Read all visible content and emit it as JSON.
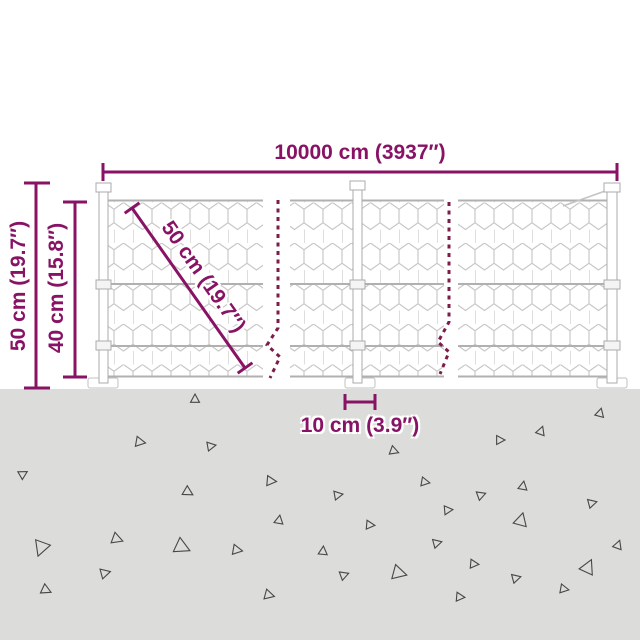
{
  "diagram": {
    "kind": "product-dimension-diagram",
    "subject": "chicken-wire mesh fence with ground spikes",
    "dimensions": {
      "total_length": "10000 cm (3937″)",
      "post_height": "50 cm (19.7″)",
      "mesh_height": "40 cm (15.8″)",
      "mesh_diagonal": "50 cm (19.7″)",
      "base_width": "10 cm (3.9″)"
    },
    "colors": {
      "dimension": "#881365",
      "break_line": "#7c1c4b",
      "mesh": "#c8c8c8",
      "wire": "#b0b0b0",
      "post_outline": "#ababab",
      "ground": "#dcdcda",
      "triangle_outline": "#474747",
      "background": "#ffffff"
    },
    "ground": {
      "triangles": [
        {
          "x": 195,
          "y": 399,
          "s": 8,
          "r": 0
        },
        {
          "x": 140,
          "y": 442,
          "s": 9,
          "r": 100
        },
        {
          "x": 211,
          "y": 446,
          "s": 8,
          "r": 80
        },
        {
          "x": 23,
          "y": 474,
          "s": 8,
          "r": 60
        },
        {
          "x": 271,
          "y": 481,
          "s": 9,
          "r": 95
        },
        {
          "x": 188,
          "y": 492,
          "s": 9,
          "r": 120
        },
        {
          "x": 279,
          "y": 520,
          "s": 8,
          "r": 10
        },
        {
          "x": 117,
          "y": 539,
          "s": 10,
          "r": 110
        },
        {
          "x": 41,
          "y": 548,
          "s": 14,
          "r": 200
        },
        {
          "x": 182,
          "y": 547,
          "s": 14,
          "r": 115
        },
        {
          "x": 237,
          "y": 550,
          "s": 9,
          "r": 100
        },
        {
          "x": 105,
          "y": 573,
          "s": 9,
          "r": 75
        },
        {
          "x": 46,
          "y": 590,
          "s": 9,
          "r": 115
        },
        {
          "x": 269,
          "y": 595,
          "s": 9,
          "r": 105
        },
        {
          "x": 600,
          "y": 413,
          "s": 8,
          "r": 15
        },
        {
          "x": 541,
          "y": 431,
          "s": 8,
          "r": 20
        },
        {
          "x": 500,
          "y": 440,
          "s": 8,
          "r": 90
        },
        {
          "x": 394,
          "y": 451,
          "s": 8,
          "r": 110
        },
        {
          "x": 425,
          "y": 482,
          "s": 8,
          "r": 100
        },
        {
          "x": 338,
          "y": 495,
          "s": 8,
          "r": 80
        },
        {
          "x": 523,
          "y": 486,
          "s": 8,
          "r": 10
        },
        {
          "x": 481,
          "y": 495,
          "s": 8,
          "r": 70
        },
        {
          "x": 592,
          "y": 503,
          "s": 8,
          "r": 75
        },
        {
          "x": 448,
          "y": 510,
          "s": 8,
          "r": 85
        },
        {
          "x": 370,
          "y": 525,
          "s": 8,
          "r": 95
        },
        {
          "x": 521,
          "y": 520,
          "s": 12,
          "r": 15
        },
        {
          "x": 437,
          "y": 543,
          "s": 8,
          "r": 75
        },
        {
          "x": 618,
          "y": 545,
          "s": 8,
          "r": 20
        },
        {
          "x": 323,
          "y": 551,
          "s": 8,
          "r": 5
        },
        {
          "x": 474,
          "y": 564,
          "s": 8,
          "r": 95
        },
        {
          "x": 344,
          "y": 575,
          "s": 8,
          "r": 70
        },
        {
          "x": 399,
          "y": 573,
          "s": 13,
          "r": 105
        },
        {
          "x": 588,
          "y": 567,
          "s": 13,
          "r": 25
        },
        {
          "x": 516,
          "y": 578,
          "s": 8,
          "r": 75
        },
        {
          "x": 564,
          "y": 589,
          "s": 8,
          "r": 100
        },
        {
          "x": 460,
          "y": 597,
          "s": 8,
          "r": 95
        }
      ]
    }
  }
}
